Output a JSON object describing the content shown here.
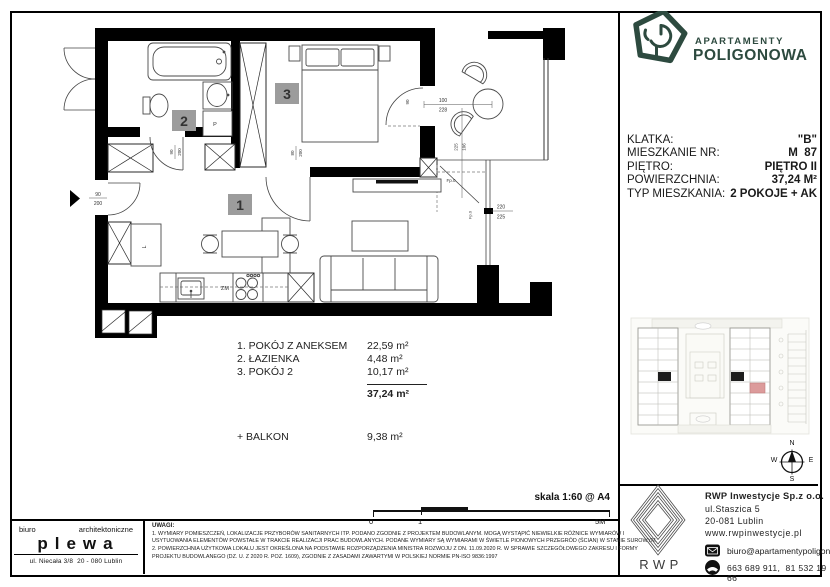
{
  "logo": {
    "line1": "APARTAMENTY",
    "line2": "POLIGONOWA",
    "color": "#2d4a3f"
  },
  "info": {
    "rows": [
      {
        "label": "KLATKA:",
        "value": "\"B\""
      },
      {
        "label": "MIESZKANIE NR:",
        "value": "M  87"
      },
      {
        "label": "PIĘTRO:",
        "value": "PIĘTRO II"
      },
      {
        "label": "POWIERZCHNIA:",
        "value": "37,24 M²"
      },
      {
        "label": "TYP MIESZKANIA:",
        "value": "2 POKOJE + AK"
      }
    ]
  },
  "plan": {
    "badges": {
      "living": "1",
      "bathroom": "2",
      "bedroom": "3"
    },
    "labels": {
      "sink": "ZM",
      "washer": "P",
      "wardrobe": "L",
      "fixed_pane": "Fp.0"
    },
    "dims": {
      "entry_w": "90",
      "entry_h": "200",
      "bath_w": "90",
      "bath_h": "200",
      "bedroom_w": "80",
      "bedroom_h": "200",
      "balcony_w": "100",
      "balcony_h": "228",
      "balcony_rot": "90",
      "side_a": "225",
      "side_b": "106",
      "window_w": "220",
      "window_h": "225"
    }
  },
  "room_list": {
    "items": [
      {
        "name": "1. POKÓJ Z ANEKSEM",
        "area": "22,59 m²"
      },
      {
        "name": "2. ŁAZIENKA",
        "area": "4,48 m²"
      },
      {
        "name": "3. POKÓJ 2",
        "area": "10,17 m²"
      }
    ],
    "total": "37,24 m²",
    "balcony_name": "+ BALKON",
    "balcony_area": "9,38 m²"
  },
  "scale": {
    "label": "skala 1:60 @ A4",
    "tick0": "0",
    "tick1": "1",
    "tick_end": "5M"
  },
  "notes": {
    "title": "UWAGI:",
    "lines": [
      "1. WYMIARY POMIESZCZEŃ, LOKALIZACJE PRZYBORÓW SANITARNYCH ITP. PODANO ZGODNIE Z PROJEKTEM BUDOWLANYM. MOGĄ WYSTĄPIĆ NIEWIELKIE RÓŻNICE WYMIARÓW I",
      "USYTUOWANIA ELEMENTÓW POWSTAŁE W TRAKCIE REALIZACJI PRAC BUDOWLANYCH. PODANE WYMIARY SĄ WYMIARAMI W ŚWIETLE PIONOWYCH PRZEGRÓD (ŚCIAN) W STANIE SUROWYM.",
      "2. POWIERZCHNIA UŻYTKOWA LOKALU JEST OKREŚLONA NA PODSTAWIE ROZPORZĄDZENIA MINISTRA ROZWOJU Z DN. 11.09.2020 R. W SPRAWIE SZCZEGÓŁOWEGO ZAKRESU I FORMY",
      "PROJEKTU BUDOWLANEGO (DZ. U. Z 2020 R. POZ. 1609), ZGODNIE Z ZASADAMI ZAWARTYMI W POLSKIEJ NORMIE PN-ISO 9836:1997"
    ]
  },
  "architect": {
    "word1": "biuro",
    "word2": "architektoniczne",
    "name": "plewa",
    "address": "ul. Niecała 3/8  20 - 080 Lublin"
  },
  "compass": {
    "n": "N",
    "s": "S",
    "e": "E",
    "w": "W"
  },
  "developer": {
    "logo_text": "RWP",
    "company": "RWP Inwestycje Sp.z o.o.",
    "street": "ul.Staszica 5",
    "city": "20-081 Lublin",
    "website": "www.rwpinwestycje.pl",
    "email": "biuro@apartamentypoligonowa.pl",
    "phones": "663 689 911,  81 532 19 66"
  }
}
